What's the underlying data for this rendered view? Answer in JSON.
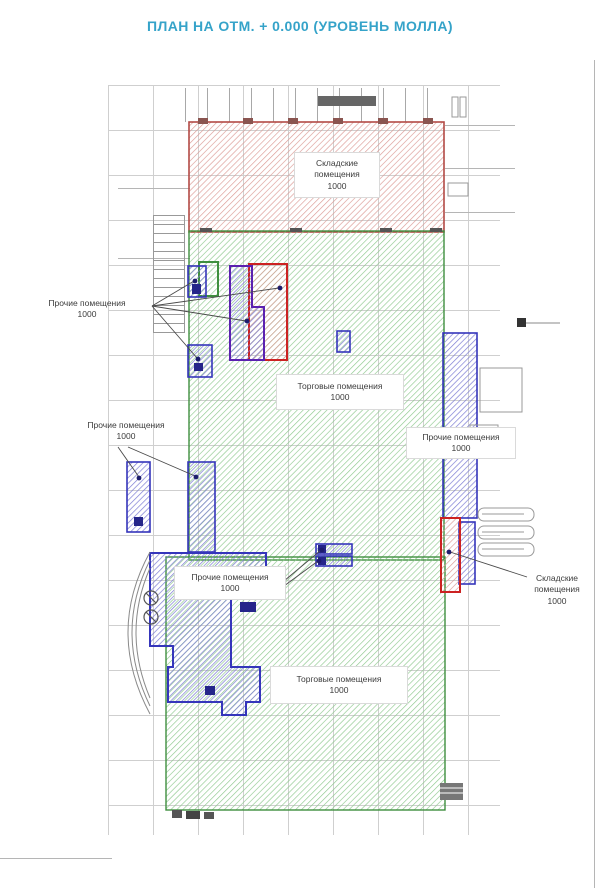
{
  "title": "ПЛАН НА ОТМ. + 0.000 (УРОВЕНЬ МОЛЛА)",
  "regions": {
    "storage_top": {
      "label": "Складские помещения",
      "value": "1000"
    },
    "trade_upper": {
      "label": "Торговые помещения",
      "value": "1000"
    },
    "trade_lower": {
      "label": "Торговые помещения",
      "value": "1000"
    },
    "other_left_upper": {
      "label": "Прочие помещения",
      "value": "1000"
    },
    "other_left_mid": {
      "label": "Прочие помещения",
      "value": "1000"
    },
    "other_right": {
      "label": "Прочие помещения",
      "value": "1000"
    },
    "other_bottom_left": {
      "label": "Прочие помещения",
      "value": "1000"
    },
    "storage_right": {
      "label": "Складские помещения",
      "value": "1000"
    }
  },
  "colors": {
    "title": "#35a3c9",
    "storage_border": "#b34a45",
    "storage_hatch": "#dc9b96",
    "trade_border": "#3f8f3f",
    "trade_hatch": "#8fc98f",
    "other_border": "#3535bb",
    "other_hatch": "#7d7dd4",
    "accent_purple": "#5b21b0",
    "accent_red": "#cc2222",
    "grid": "#cfcfcf"
  }
}
